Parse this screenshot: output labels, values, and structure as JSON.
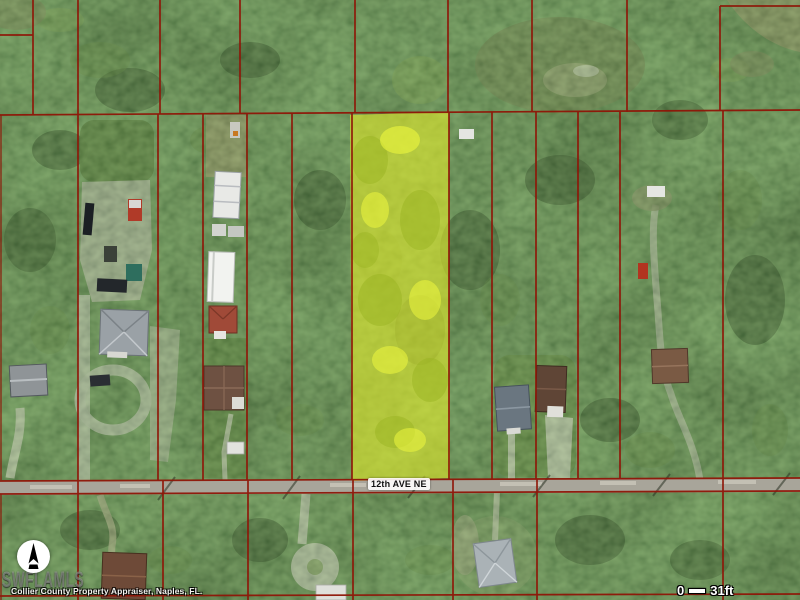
{
  "map_overlay": {
    "street_label": "12th AVE NE",
    "watermark_text": "SWFLAMLS",
    "attribution_text": "Collier County Property Appraiser, Naples, FL.",
    "scale_bar": {
      "start": "0",
      "end": "31ft"
    },
    "compass_icon": "north-arrow",
    "colors": {
      "parcel_line": "#8f1507",
      "parcel_highlight": "#dfe92c",
      "road_surface": "#a8a59a"
    }
  }
}
